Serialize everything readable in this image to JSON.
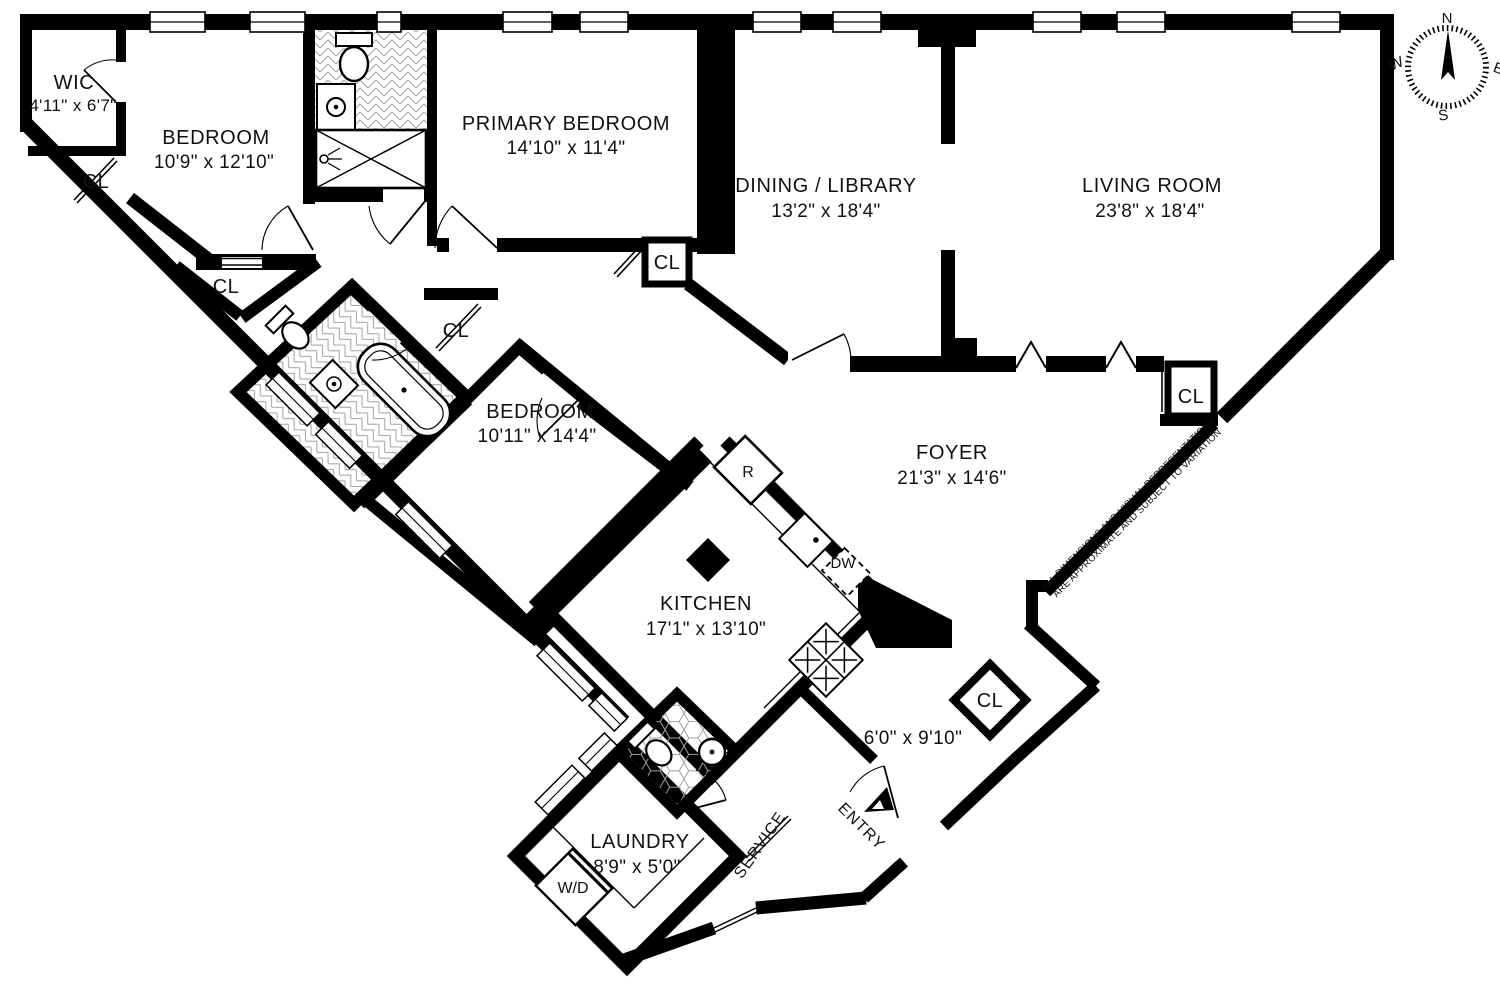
{
  "rooms": {
    "wic": {
      "name": "WIC",
      "dims": "4'11\" x 6'7\""
    },
    "bedroom_top": {
      "name": "BEDROOM",
      "dims": "10'9\" x 12'10\""
    },
    "primary_bedroom": {
      "name": "PRIMARY BEDROOM",
      "dims": "14'10\" x 11'4\""
    },
    "dining_library": {
      "name": "DINING / LIBRARY",
      "dims": "13'2\" x 18'4\""
    },
    "living_room": {
      "name": "LIVING ROOM",
      "dims": "23'8\" x 18'4\""
    },
    "bedroom_mid": {
      "name": "BEDROOM",
      "dims": "10'11\" x 14'4\""
    },
    "foyer": {
      "name": "FOYER",
      "dims": "21'3\" x 14'6\""
    },
    "kitchen": {
      "name": "KITCHEN",
      "dims": "17'1\" x 13'10\""
    },
    "laundry": {
      "name": "LAUNDRY",
      "dims": "8'9\" x 5'0\""
    },
    "entry_hall": {
      "dims": "6'0\" x 9'10\""
    }
  },
  "labels": {
    "closet": "CL",
    "washer_dryer": "W/D",
    "refrigerator": "R",
    "dishwasher": "DW",
    "service": "SERVICE",
    "entry": "ENTRY"
  },
  "compass": {
    "north": "N",
    "south": "S",
    "east": "E",
    "west": "W"
  },
  "disclaimer": {
    "line1": "ALL DIMENSIONS AND VISUAL REPRESENTATIONS",
    "line2": "ARE APPROXIMATE AND SUBJECT TO VARIATION"
  },
  "colors": {
    "wall": "#000000",
    "background": "#ffffff",
    "tile": "#9a9a9a"
  }
}
